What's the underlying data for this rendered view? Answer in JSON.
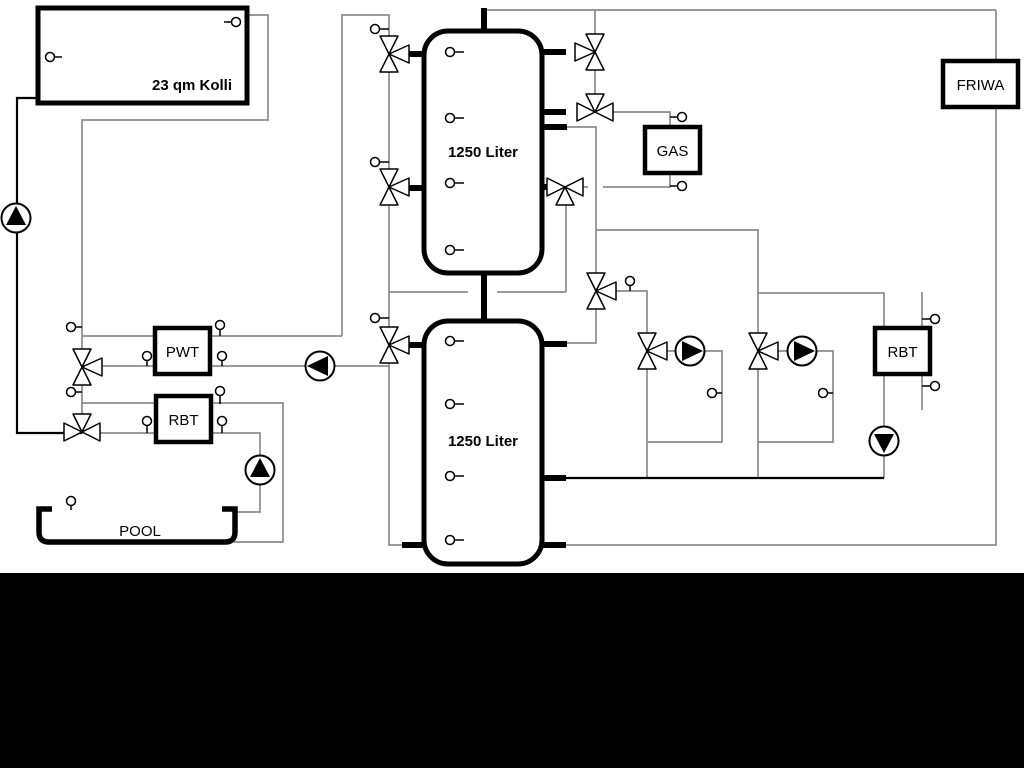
{
  "diagram": {
    "type": "hydraulic-heating-schematic",
    "background_color": "#ffffff",
    "pipe_color": "#8c8c8c",
    "outline_color": "#000000",
    "footer_bar_color": "#000000",
    "labels": {
      "solar_collector": "23 qm Kolli",
      "buffer_tank_1": "1250 Liter",
      "buffer_tank_2": "1250 Liter",
      "pwt": "PWT",
      "rbt_left": "RBT",
      "gas_boiler": "GAS",
      "friwa": "FRIWA",
      "rbt_right": "RBT",
      "pool": "POOL"
    },
    "component_counts": {
      "three_way_valves": 11,
      "pumps": 6,
      "temperature_sensors": 29
    }
  }
}
